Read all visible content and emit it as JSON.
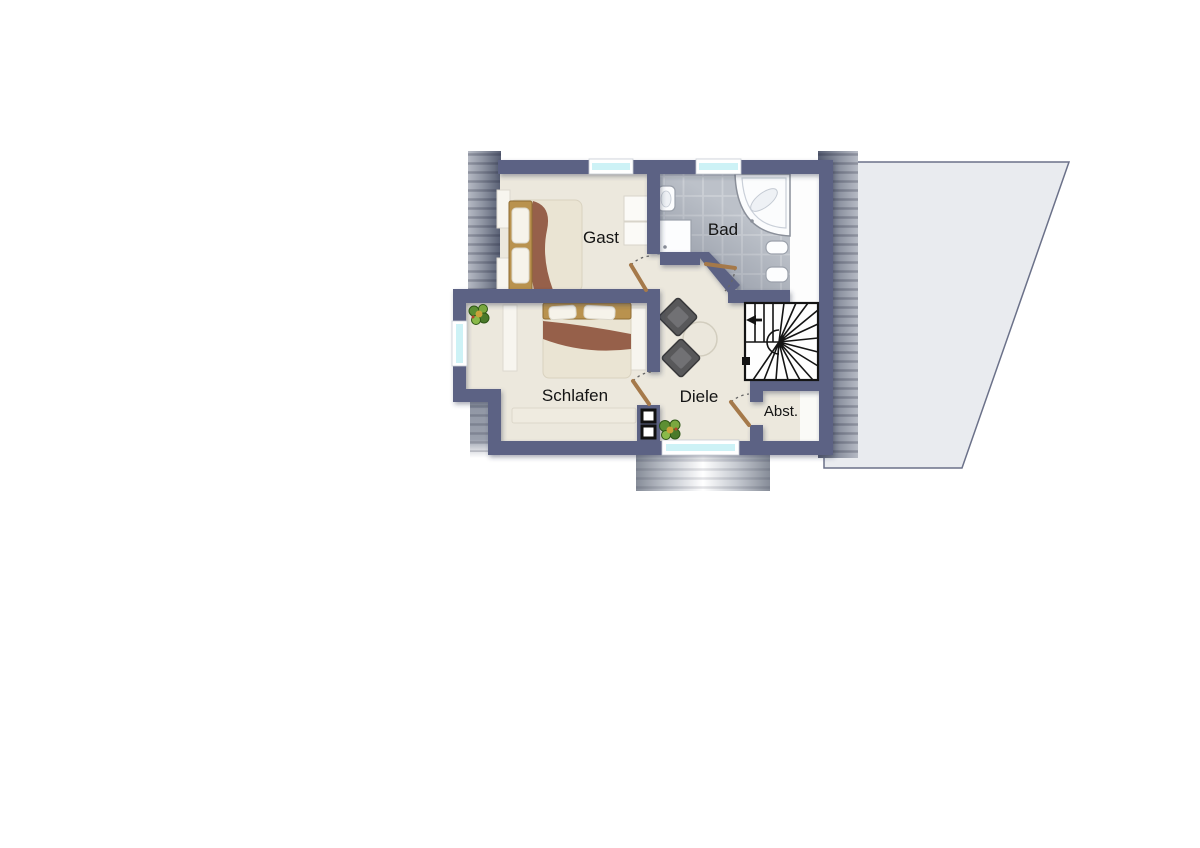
{
  "floorplan": {
    "rooms": [
      {
        "id": "gast",
        "label": "Gast"
      },
      {
        "id": "bad",
        "label": "Bad"
      },
      {
        "id": "schlafen",
        "label": "Schlafen"
      },
      {
        "id": "diele",
        "label": "Diele"
      },
      {
        "id": "abst",
        "label": "Abst."
      }
    ],
    "features": [
      "single-bed",
      "double-bed",
      "wardrobe",
      "nightstand",
      "bathtub",
      "shower",
      "washbasin",
      "toilet",
      "bidet",
      "winder-staircase",
      "stool",
      "side-table",
      "plant",
      "chimney",
      "window",
      "door",
      "roof-plane",
      "roof-hatch",
      "dormer"
    ],
    "colors": {
      "background": "#ffffff",
      "wall": "#5c6284",
      "floor": "#ece8dd",
      "tile": "#bcc1c9",
      "tile_grout": "#ccd0d6",
      "white_area": "#fdfdfd",
      "window_glass": "#cdf2f6",
      "door_leaf": "#a5794a",
      "roof_dark": "#565d72",
      "roof_light": "#b3b8c2",
      "roof_plane": "#e9ebef",
      "stair_line": "#141414",
      "wood": "#b9924e",
      "blanket": "#96604a",
      "mattress": "#eae4d3",
      "furniture": "#f7f5ef",
      "stool": "#58585a",
      "plant": "#5c8f33",
      "label_text": "#141414"
    }
  }
}
